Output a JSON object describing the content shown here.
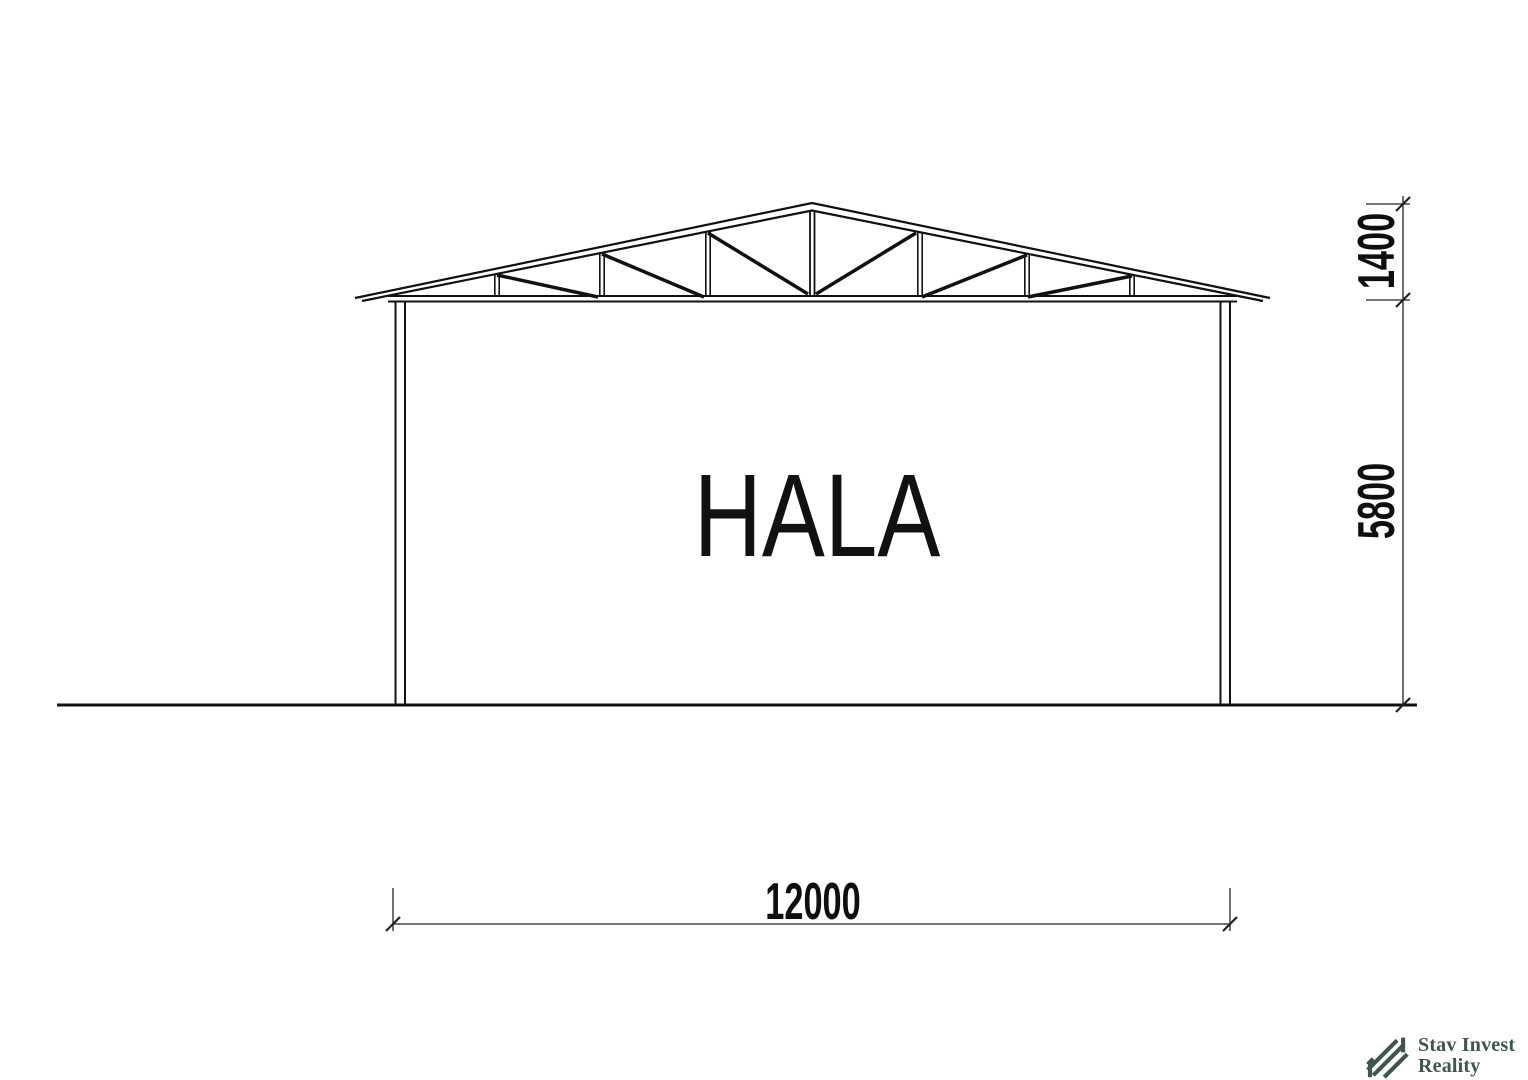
{
  "drawing": {
    "type": "architectural-section",
    "room_label": "HALA",
    "dimensions": {
      "width": "12000",
      "wall_height": "5800",
      "roof_height": "1400"
    }
  },
  "logo": {
    "line1": "Stav Invest",
    "line2": "Reality",
    "color": "#3d554e"
  },
  "colors": {
    "background": "#ffffff",
    "drawing_line": "#111111",
    "dimension_line": "#222222"
  }
}
